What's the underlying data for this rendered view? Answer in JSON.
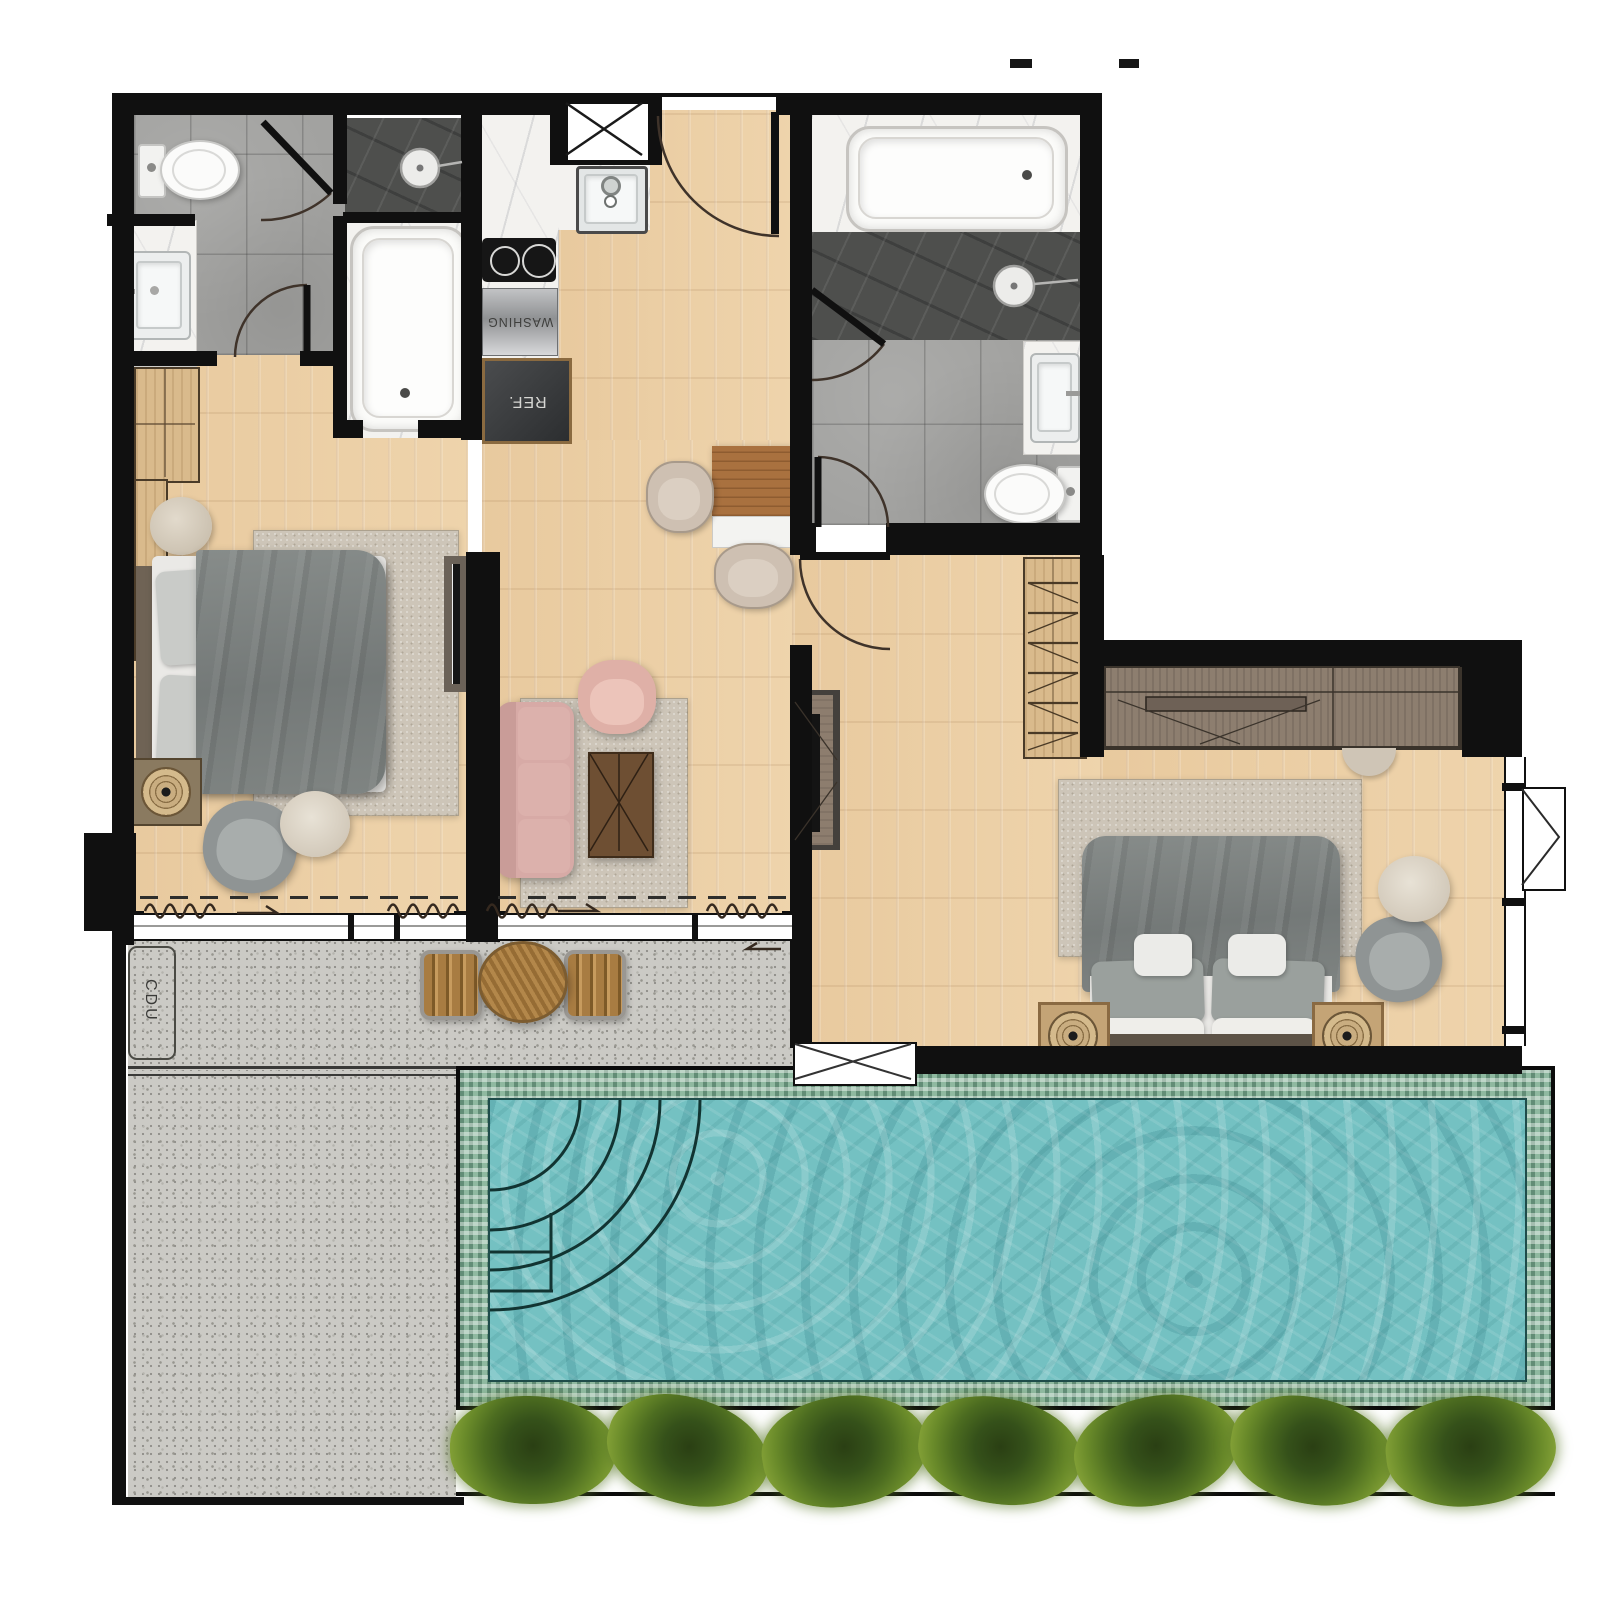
{
  "labels": {
    "washing": "WASHING",
    "refrigerator": "REF.",
    "cdu": "CDU"
  },
  "palette": {
    "wall": "#101010",
    "wood": "#ecd0a7",
    "tile": "#a2a2a0",
    "shower_dark": "#4e4f4d",
    "marble": "#f3f2ef",
    "terrace": "#cbcac5",
    "pool_water": "#74c1c2",
    "pool_mosaic": "#8fb9a0",
    "rug": "#cdc5b8",
    "closet_wood": "#d9ba8c",
    "dresser_wood": "#8d7e6f",
    "sofa": "#d7aaa6",
    "duvet": "#7e8381",
    "hedge": "#4c6c20"
  }
}
